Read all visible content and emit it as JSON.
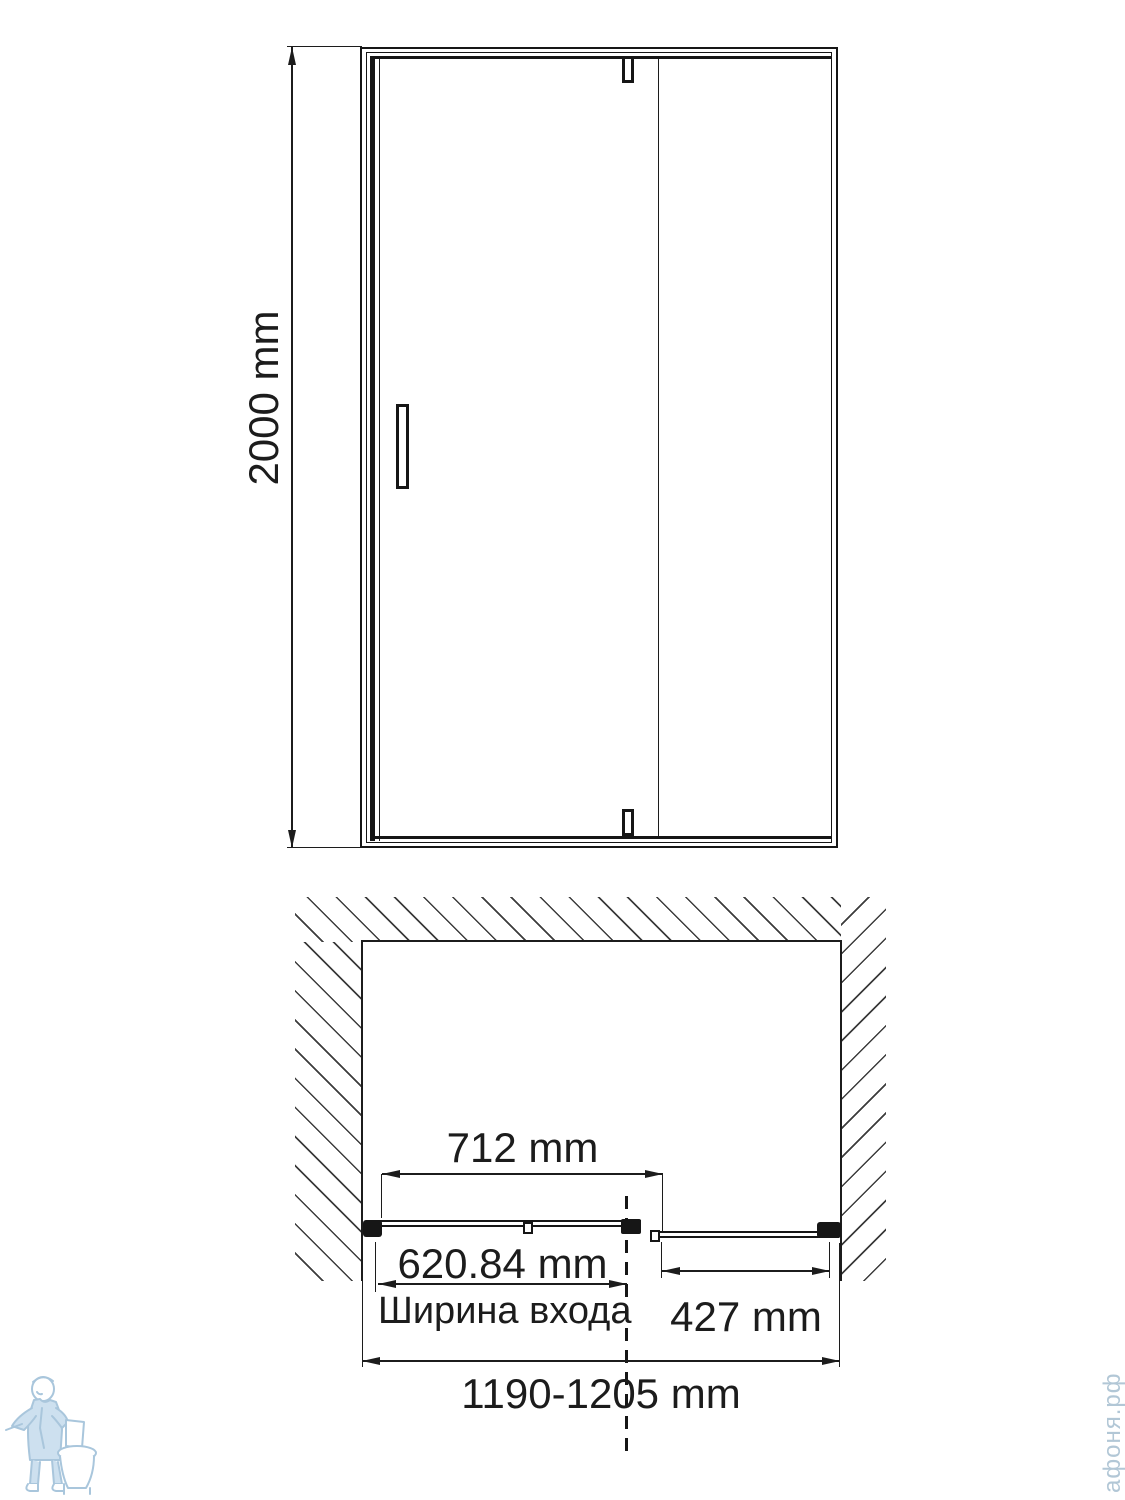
{
  "front_view": {
    "height_label": "2000 mm"
  },
  "plan_view": {
    "door_panel_width_label": "712 mm",
    "entrance_width_label": "620.84 mm",
    "entrance_width_caption": "Ширина входа",
    "fixed_panel_width_label": "427 mm",
    "overall_width_label": "1190-1205 mm"
  },
  "watermark": {
    "site_name_vertical": "афоня.рф"
  },
  "colors": {
    "line": "#1c1c1c",
    "watermark_blue": "#a9c6dc",
    "watermark_text": "#b2c7d6"
  }
}
